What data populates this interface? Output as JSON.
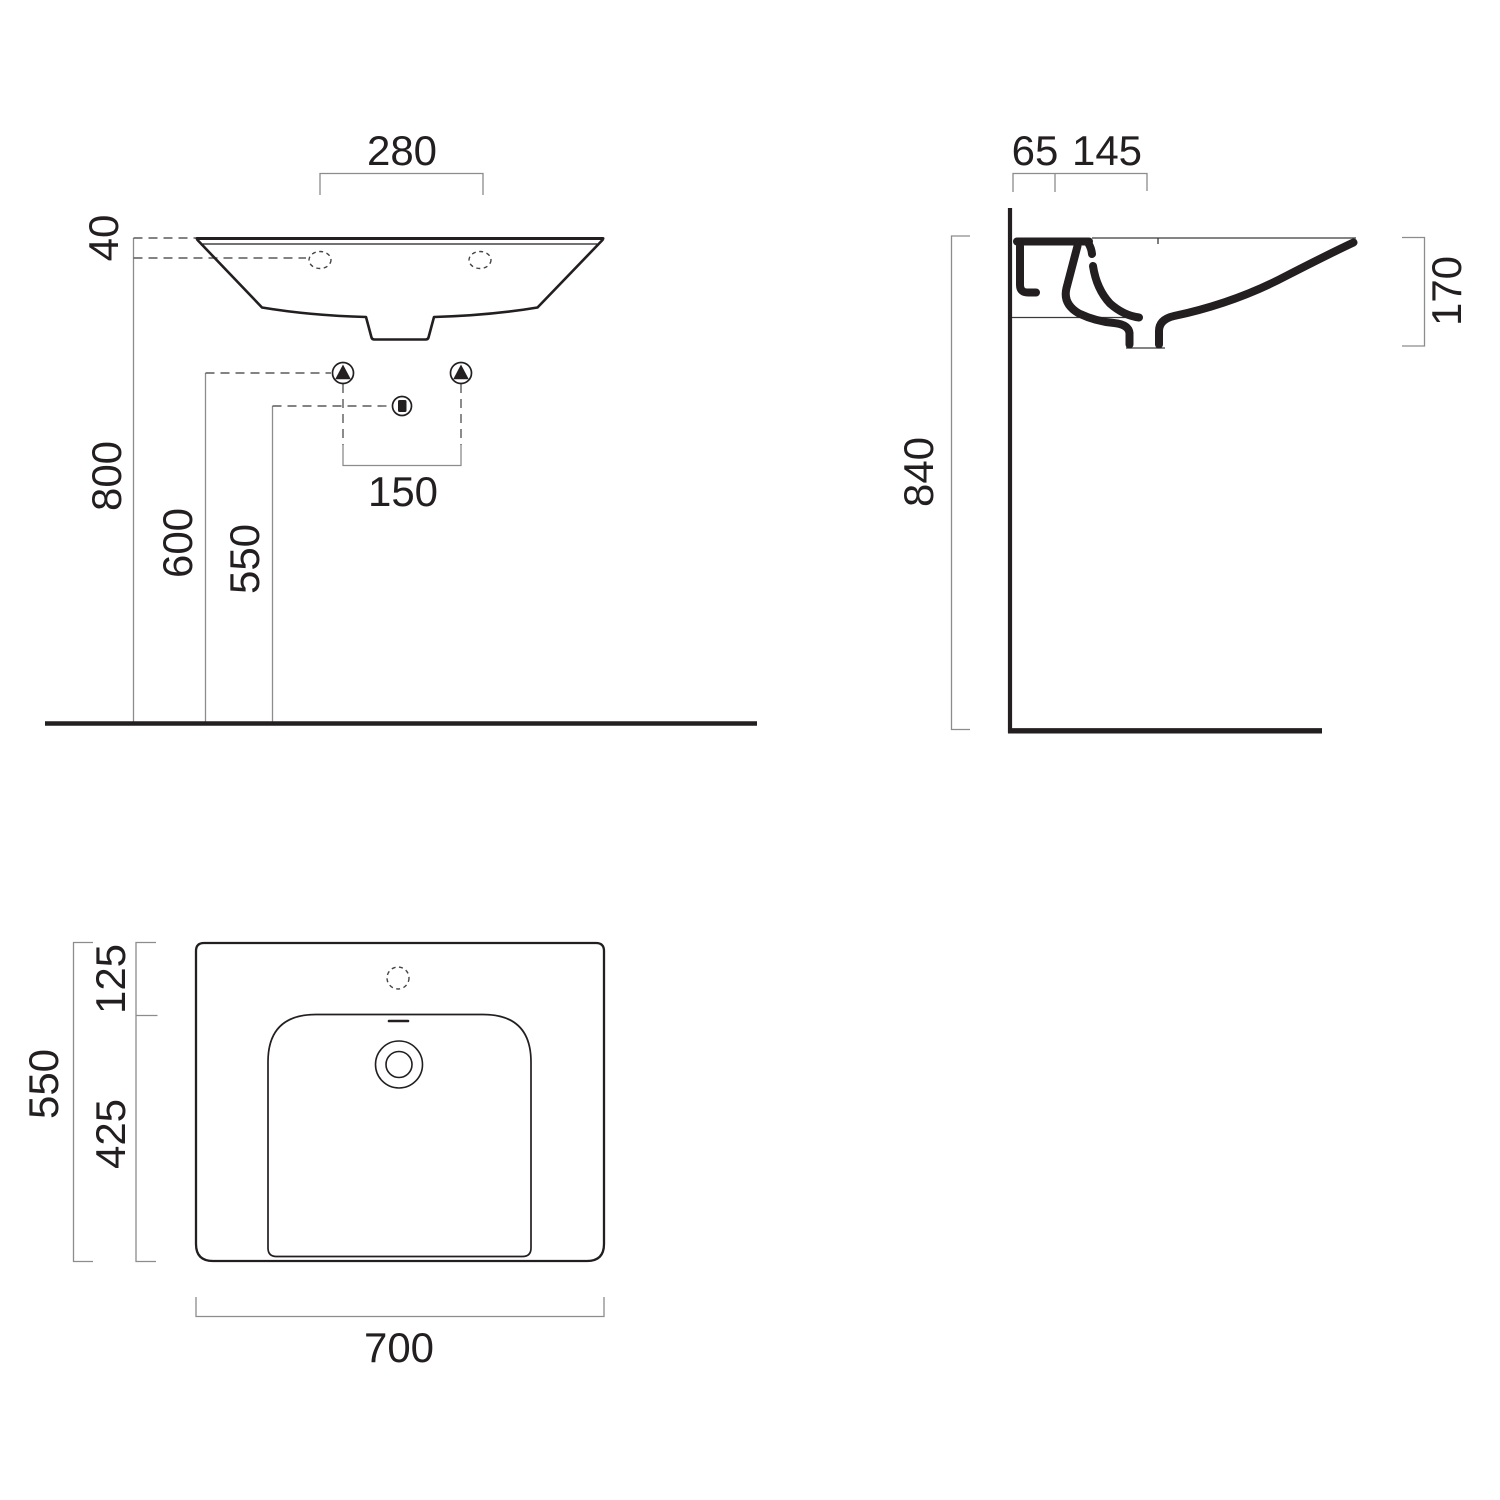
{
  "drawing": {
    "unit_note": "",
    "colors": {
      "ink": "#231f20",
      "dimension_line": "#8c8c8c",
      "dashed_leader": "#5a5a5a",
      "background": "#ffffff"
    }
  },
  "front_view": {
    "tap_hole_spacing": "280",
    "rim_thickness": "40",
    "rim_height": "800",
    "supply_height": "600",
    "waste_height": "550",
    "supply_spacing": "150",
    "symbols": {
      "water_supply": "triangle-in-circle",
      "waste_outlet": "square-in-circle",
      "tap_holes": "dashed-ellipse"
    }
  },
  "side_view": {
    "fixing_offset": "65",
    "tap_centre_offset": "145",
    "overall_height": "840",
    "basin_depth": "170"
  },
  "plan_view": {
    "deck_depth": "125",
    "bowl_length": "425",
    "overall_depth": "550",
    "overall_width": "700"
  }
}
